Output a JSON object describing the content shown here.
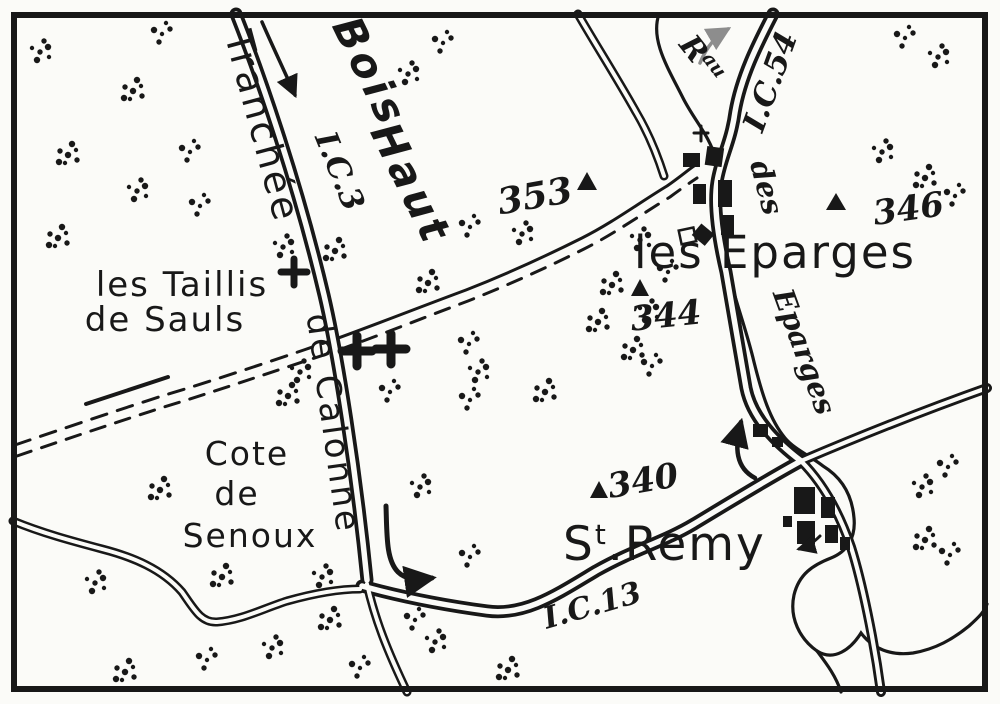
{
  "colors": {
    "ink": "#181818",
    "paper": "#fbfbf8",
    "gray_arrow": "#8d8d8d"
  },
  "map": {
    "region_labels": {
      "bois": "Bois",
      "haut": "Haut",
      "les_taillis": "les Taillis",
      "de_sauls": "de Sauls",
      "cote": "Cote",
      "de": "de",
      "senoux": "Senoux"
    },
    "place_labels": {
      "les_eparges": "les Eparges",
      "st_s": "S",
      "st_t": "t",
      "st_dot": ".",
      "st_remy": "Remy"
    },
    "road_labels": {
      "tranchee": "Tranchée",
      "de_calonne": "de Calonne",
      "ic3": "I.C.3",
      "ic13": "I.C.13",
      "ic54": "I.C.54"
    },
    "stream_labels": {
      "rau_r": "R",
      "rau_sup": "au",
      "des": "des",
      "eparges": "Eparges"
    },
    "elevations": {
      "p353": "353",
      "p344": "344",
      "p346": "346",
      "p340": "340"
    },
    "tree_clusters": [
      [
        162,
        34
      ],
      [
        40,
        52
      ],
      [
        133,
        91
      ],
      [
        443,
        43
      ],
      [
        408,
        74
      ],
      [
        68,
        155
      ],
      [
        190,
        152
      ],
      [
        137,
        191
      ],
      [
        58,
        238
      ],
      [
        200,
        206
      ],
      [
        283,
        247
      ],
      [
        335,
        251
      ],
      [
        470,
        227
      ],
      [
        522,
        234
      ],
      [
        428,
        283
      ],
      [
        469,
        344
      ],
      [
        478,
        372
      ],
      [
        545,
        392
      ],
      [
        470,
        400
      ],
      [
        300,
        372
      ],
      [
        288,
        396
      ],
      [
        390,
        392
      ],
      [
        640,
        240
      ],
      [
        612,
        285
      ],
      [
        668,
        272
      ],
      [
        648,
        312
      ],
      [
        598,
        322
      ],
      [
        905,
        38
      ],
      [
        938,
        57
      ],
      [
        925,
        178
      ],
      [
        955,
        196
      ],
      [
        882,
        152
      ],
      [
        633,
        350
      ],
      [
        652,
        366
      ],
      [
        420,
        487
      ],
      [
        160,
        490
      ],
      [
        415,
        620
      ],
      [
        322,
        577
      ],
      [
        330,
        620
      ],
      [
        360,
        668
      ],
      [
        435,
        642
      ],
      [
        508,
        670
      ],
      [
        470,
        557
      ],
      [
        95,
        583
      ],
      [
        222,
        577
      ],
      [
        207,
        660
      ],
      [
        272,
        648
      ],
      [
        125,
        672
      ],
      [
        948,
        467
      ],
      [
        922,
        487
      ],
      [
        925,
        540
      ],
      [
        950,
        555
      ]
    ]
  }
}
